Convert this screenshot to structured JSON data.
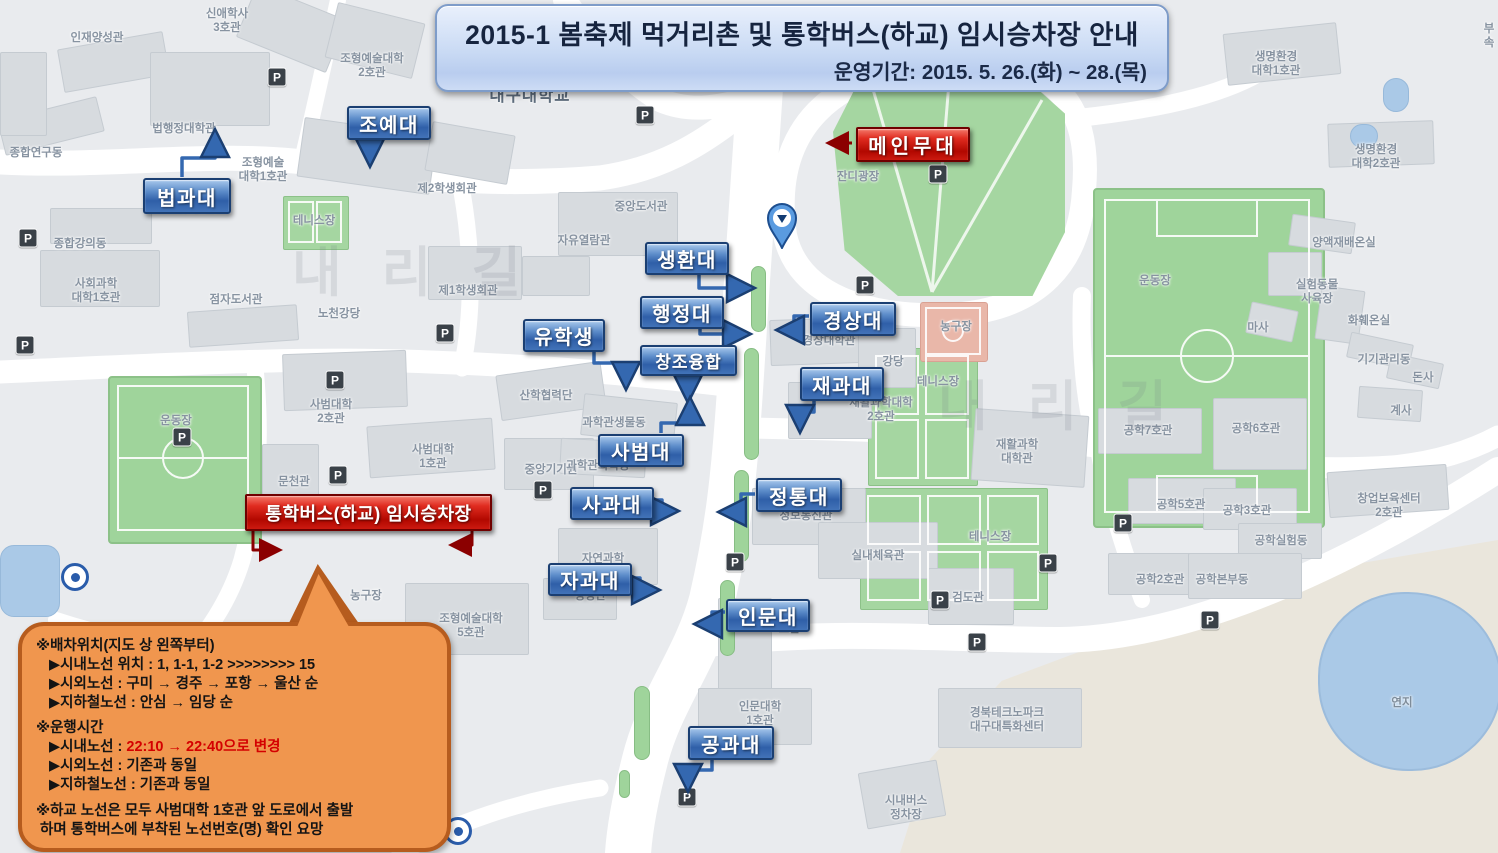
{
  "banner": {
    "title": "2015-1 봄축제 먹거리촌 및 통학버스(하교) 임시승차장 안내",
    "subtitle": "운영기간: 2015. 5. 26.(화) ~ 28.(목)"
  },
  "stage_label": {
    "text": "메인무대",
    "x": 856,
    "y": 127,
    "w": 110,
    "h": 31,
    "arrow": [
      [
        852,
        143
      ],
      [
        831,
        143
      ]
    ]
  },
  "bus_stop_label": {
    "text": "통학버스(하교) 임시승차장",
    "x": 245,
    "y": 494,
    "w": 243,
    "h": 33,
    "arrows": [
      [
        [
          253,
          528
        ],
        [
          253,
          550
        ],
        [
          277,
          550
        ]
      ],
      [
        [
          472,
          528
        ],
        [
          472,
          545
        ],
        [
          454,
          545
        ]
      ]
    ]
  },
  "college_labels": [
    {
      "text": "조예대",
      "x": 347,
      "y": 106,
      "w": 80,
      "h": 30,
      "arrow": [
        [
          370,
          139
        ],
        [
          370,
          160
        ]
      ]
    },
    {
      "text": "법과대",
      "x": 143,
      "y": 178,
      "w": 84,
      "h": 32,
      "arrow": [
        [
          182,
          177
        ],
        [
          182,
          158
        ],
        [
          215,
          158
        ],
        [
          215,
          136
        ]
      ]
    },
    {
      "text": "생환대",
      "x": 645,
      "y": 242,
      "w": 80,
      "h": 29,
      "arrow": [
        [
          699,
          272
        ],
        [
          699,
          288
        ],
        [
          748,
          288
        ]
      ]
    },
    {
      "text": "행정대",
      "x": 640,
      "y": 296,
      "w": 80,
      "h": 29,
      "arrow": [
        [
          700,
          326
        ],
        [
          700,
          334
        ],
        [
          744,
          334
        ]
      ]
    },
    {
      "text": "유학생",
      "x": 523,
      "y": 319,
      "w": 78,
      "h": 29,
      "arrow": [
        [
          594,
          349
        ],
        [
          594,
          363
        ],
        [
          626,
          363
        ],
        [
          626,
          383
        ]
      ]
    },
    {
      "text": "창조융합",
      "x": 640,
      "y": 345,
      "w": 93,
      "h": 27,
      "fs": "small",
      "arrow": [
        [
          688,
          373
        ],
        [
          688,
          396
        ]
      ]
    },
    {
      "text": "경상대",
      "x": 810,
      "y": 302,
      "w": 82,
      "h": 30,
      "arrow": [
        [
          809,
          316
        ],
        [
          794,
          316
        ],
        [
          794,
          330
        ],
        [
          783,
          330
        ]
      ]
    },
    {
      "text": "재과대",
      "x": 800,
      "y": 367,
      "w": 80,
      "h": 30,
      "arrow": [
        [
          814,
          398
        ],
        [
          814,
          412
        ],
        [
          800,
          412
        ],
        [
          800,
          426
        ]
      ]
    },
    {
      "text": "사범대",
      "x": 598,
      "y": 434,
      "w": 82,
      "h": 29,
      "arrow": [
        [
          661,
          433
        ],
        [
          661,
          423
        ],
        [
          690,
          423
        ],
        [
          690,
          404
        ]
      ]
    },
    {
      "text": "사과대",
      "x": 570,
      "y": 487,
      "w": 80,
      "h": 29,
      "arrow": [
        [
          651,
          500
        ],
        [
          662,
          500
        ],
        [
          662,
          511
        ],
        [
          672,
          511
        ]
      ]
    },
    {
      "text": "정통대",
      "x": 756,
      "y": 478,
      "w": 82,
      "h": 30,
      "arrow": [
        [
          755,
          494
        ],
        [
          741,
          494
        ],
        [
          741,
          512
        ],
        [
          725,
          512
        ]
      ]
    },
    {
      "text": "자과대",
      "x": 548,
      "y": 563,
      "w": 80,
      "h": 29,
      "arrow": [
        [
          629,
          578
        ],
        [
          640,
          578
        ],
        [
          640,
          590
        ],
        [
          653,
          590
        ]
      ]
    },
    {
      "text": "인문대",
      "x": 726,
      "y": 599,
      "w": 80,
      "h": 29,
      "arrow": [
        [
          725,
          612
        ],
        [
          712,
          612
        ],
        [
          712,
          624
        ],
        [
          701,
          624
        ]
      ]
    },
    {
      "text": "공과대",
      "x": 688,
      "y": 726,
      "w": 82,
      "h": 30,
      "arrow": [
        [
          712,
          757
        ],
        [
          712,
          770
        ],
        [
          688,
          770
        ],
        [
          688,
          785
        ]
      ]
    }
  ],
  "notice": {
    "sections": [
      {
        "header": "※배차위치(지도 상 왼쪽부터)",
        "items": [
          "▶시내노선 위치 : 1, 1-1, 1-2 >>>>>>>> 15",
          "▶시외노선 : 구미 → 경주 → 포항 → 울산 순",
          "▶지하철노선 : 안심 → 임당 순"
        ]
      },
      {
        "header": "※운행시간",
        "items": [
          {
            "prefix": "▶시내노선 : ",
            "highlight": "22:10 → 22:40으로 변경"
          },
          "▶시외노선 : 기존과 동일",
          "▶지하철노선 : 기존과 동일"
        ]
      },
      {
        "header": "※하교 노선은 모두 사범대학 1호관 앞 도로에서 출발\n 하며 통학버스에 부착된 노선번호(명) 확인 요망",
        "items": []
      }
    ]
  },
  "colors": {
    "college_label_blue": "#2f5fa8",
    "alert_label_red": "#c00000",
    "notice_bg": "#f0964e",
    "banner_bg": "#c9daf4",
    "map_green": "#a5d6a1",
    "road_white": "#ffffff",
    "arrow_blue": "#3468b0",
    "arrow_red": "#8b0000",
    "pond_blue": "#aac9e7"
  },
  "map": {
    "parking_icon": "P",
    "parking_positions": [
      [
        277,
        77
      ],
      [
        645,
        115
      ],
      [
        938,
        174
      ],
      [
        28,
        238
      ],
      [
        25,
        345
      ],
      [
        445,
        333
      ],
      [
        335,
        380
      ],
      [
        182,
        437
      ],
      [
        543,
        490
      ],
      [
        735,
        562
      ],
      [
        940,
        600
      ],
      [
        977,
        642
      ],
      [
        1210,
        620
      ],
      [
        1048,
        563
      ],
      [
        1123,
        523
      ],
      [
        687,
        797
      ],
      [
        865,
        285
      ],
      [
        338,
        475
      ]
    ],
    "metro_positions": [
      [
        75,
        577
      ],
      [
        458,
        831
      ]
    ],
    "median_strips": [
      [
        751,
        266,
        13,
        64
      ],
      [
        744,
        348,
        13,
        110
      ],
      [
        734,
        470,
        13,
        90
      ],
      [
        720,
        580,
        13,
        74
      ],
      [
        634,
        686,
        14,
        72
      ],
      [
        619,
        770,
        9,
        26
      ]
    ],
    "watermarks": [
      {
        "text": "내리길",
        "x": 292,
        "y": 228
      },
      {
        "text": "내리길",
        "x": 938,
        "y": 362
      }
    ],
    "green_areas": [
      {
        "type": "lawn",
        "x": 833,
        "y": 68,
        "w": 232,
        "h": 228
      },
      {
        "type": "field",
        "x": 1093,
        "y": 188,
        "w": 228,
        "h": 336
      },
      {
        "type": "field",
        "x": 108,
        "y": 376,
        "w": 150,
        "h": 164
      },
      {
        "type": "tennis",
        "x": 283,
        "y": 196,
        "w": 64,
        "h": 52
      },
      {
        "type": "tennis",
        "x": 868,
        "y": 348,
        "w": 108,
        "h": 136
      },
      {
        "type": "tennis",
        "x": 860,
        "y": 488,
        "w": 186,
        "h": 120
      },
      {
        "type": "bball",
        "x": 920,
        "y": 302,
        "w": 66,
        "h": 58
      },
      {
        "type": "water",
        "x": 0,
        "y": 545,
        "w": 58,
        "h": 70
      },
      {
        "type": "water",
        "x": 1383,
        "y": 78,
        "w": 24,
        "h": 32
      },
      {
        "type": "water",
        "x": 1350,
        "y": 124,
        "w": 26,
        "h": 22
      }
    ],
    "pond": {
      "x": 1318,
      "y": 592,
      "w": 180,
      "h": 175
    },
    "offland": {
      "x": 900,
      "y": 540,
      "w": 598,
      "h": 313
    },
    "buildings": [
      [
        60,
        40,
        105,
        42,
        -10
      ],
      [
        243,
        0,
        95,
        55,
        22
      ],
      [
        330,
        12,
        88,
        55,
        14
      ],
      [
        150,
        52,
        118,
        72,
        0
      ],
      [
        0,
        108,
        100,
        34,
        -14
      ],
      [
        50,
        208,
        100,
        34,
        0
      ],
      [
        40,
        250,
        118,
        55,
        0
      ],
      [
        188,
        308,
        108,
        34,
        -4
      ],
      [
        300,
        126,
        132,
        58,
        8
      ],
      [
        428,
        128,
        82,
        48,
        10
      ],
      [
        428,
        246,
        92,
        52,
        0
      ],
      [
        558,
        192,
        118,
        62,
        0
      ],
      [
        522,
        256,
        66,
        38,
        0
      ],
      [
        283,
        352,
        122,
        55,
        -2
      ],
      [
        368,
        422,
        124,
        50,
        -4
      ],
      [
        262,
        444,
        55,
        58,
        0
      ],
      [
        498,
        368,
        104,
        44,
        -8
      ],
      [
        504,
        438,
        88,
        50,
        0
      ],
      [
        558,
        528,
        98,
        55,
        0
      ],
      [
        543,
        578,
        72,
        40,
        0
      ],
      [
        405,
        583,
        122,
        70,
        0
      ],
      [
        770,
        318,
        118,
        44,
        -2
      ],
      [
        858,
        328,
        56,
        58,
        0
      ],
      [
        788,
        382,
        82,
        55,
        0
      ],
      [
        973,
        412,
        112,
        70,
        4
      ],
      [
        752,
        488,
        112,
        55,
        0
      ],
      [
        818,
        522,
        118,
        55,
        0
      ],
      [
        928,
        568,
        84,
        55,
        0
      ],
      [
        718,
        598,
        52,
        118,
        0
      ],
      [
        698,
        688,
        112,
        55,
        0
      ],
      [
        938,
        688,
        142,
        58,
        0
      ],
      [
        1098,
        408,
        102,
        44,
        0
      ],
      [
        1213,
        398,
        92,
        70,
        0
      ],
      [
        1128,
        478,
        106,
        44,
        0
      ],
      [
        1203,
        488,
        92,
        40,
        0
      ],
      [
        1238,
        523,
        82,
        34,
        0
      ],
      [
        1108,
        553,
        92,
        40,
        0
      ],
      [
        1188,
        553,
        112,
        44,
        0
      ],
      [
        1328,
        468,
        118,
        44,
        -4
      ],
      [
        1225,
        28,
        112,
        50,
        -6
      ],
      [
        1328,
        122,
        104,
        42,
        -2
      ],
      [
        1290,
        218,
        62,
        30,
        8
      ],
      [
        1268,
        252,
        52,
        42,
        0
      ],
      [
        1248,
        306,
        46,
        30,
        12
      ],
      [
        1318,
        288,
        42,
        52,
        8
      ],
      [
        1348,
        338,
        62,
        24,
        12
      ],
      [
        1388,
        358,
        52,
        24,
        12
      ],
      [
        1358,
        388,
        62,
        30,
        4
      ],
      [
        0,
        52,
        45,
        82,
        0
      ],
      [
        862,
        766,
        78,
        55,
        -10
      ],
      [
        582,
        398,
        92,
        40,
        6
      ],
      [
        560,
        440,
        84,
        34,
        3
      ]
    ],
    "place_labels": [
      {
        "t": "인재양성관",
        "x": 97,
        "y": 31
      },
      {
        "t": "신애학사\n3호관",
        "x": 227,
        "y": 7
      },
      {
        "t": "조형예술대학\n2호관",
        "x": 372,
        "y": 52
      },
      {
        "t": "대구대학교",
        "x": 530,
        "y": 86,
        "cls": "univ"
      },
      {
        "t": "부속",
        "x": 1489,
        "y": 22
      },
      {
        "t": "생명환경\n대학1호관",
        "x": 1276,
        "y": 50
      },
      {
        "t": "생명환경\n대학2호관",
        "x": 1376,
        "y": 143
      },
      {
        "t": "종합연구동",
        "x": 36,
        "y": 146
      },
      {
        "t": "법행정대학관",
        "x": 184,
        "y": 122
      },
      {
        "t": "지원센터",
        "x": 196,
        "y": 202
      },
      {
        "t": "조형예술\n대학1호관",
        "x": 263,
        "y": 156
      },
      {
        "t": "테니스장",
        "x": 314,
        "y": 214
      },
      {
        "t": "제2학생회관",
        "x": 447,
        "y": 182
      },
      {
        "t": "종합강의동",
        "x": 80,
        "y": 237
      },
      {
        "t": "사회과학\n대학1호관",
        "x": 96,
        "y": 277
      },
      {
        "t": "점자도서관",
        "x": 236,
        "y": 293
      },
      {
        "t": "노천강당",
        "x": 339,
        "y": 307
      },
      {
        "t": "제1학생회관",
        "x": 468,
        "y": 284
      },
      {
        "t": "자유열람관",
        "x": 584,
        "y": 234
      },
      {
        "t": "중앙도서관",
        "x": 641,
        "y": 200
      },
      {
        "t": "잔디광장",
        "x": 858,
        "y": 170
      },
      {
        "t": "경상대학관",
        "x": 829,
        "y": 334
      },
      {
        "t": "강당",
        "x": 893,
        "y": 355
      },
      {
        "t": "농구장",
        "x": 956,
        "y": 320
      },
      {
        "t": "테니스장",
        "x": 938,
        "y": 375
      },
      {
        "t": "재활과학대학\n2호관",
        "x": 881,
        "y": 396
      },
      {
        "t": "재활과학\n대학관",
        "x": 1017,
        "y": 438
      },
      {
        "t": "테니스장",
        "x": 990,
        "y": 530
      },
      {
        "t": "정보통신관",
        "x": 806,
        "y": 509
      },
      {
        "t": "실내체육관",
        "x": 878,
        "y": 549
      },
      {
        "t": "검도관",
        "x": 968,
        "y": 591
      },
      {
        "t": "산학협력단",
        "x": 546,
        "y": 389
      },
      {
        "t": "중앙기기원",
        "x": 551,
        "y": 463
      },
      {
        "t": "과학관생물동",
        "x": 614,
        "y": 416
      },
      {
        "t": "과학관화학동",
        "x": 598,
        "y": 459
      },
      {
        "t": "사범대학\n2호관",
        "x": 331,
        "y": 398
      },
      {
        "t": "사범대학\n1호관",
        "x": 433,
        "y": 443
      },
      {
        "t": "문천관",
        "x": 294,
        "y": 475
      },
      {
        "t": "운동장",
        "x": 176,
        "y": 414
      },
      {
        "t": "농구장",
        "x": 366,
        "y": 589
      },
      {
        "t": "조형예술대학\n5호관",
        "x": 471,
        "y": 612
      },
      {
        "t": "자연과학\n대학관",
        "x": 603,
        "y": 552
      },
      {
        "t": "생명관",
        "x": 590,
        "y": 589
      },
      {
        "t": "인문대학\n1호관",
        "x": 760,
        "y": 700
      },
      {
        "t": "2호관",
        "x": 786,
        "y": 622
      },
      {
        "t": "경북테크노파크\n대구대특화센터",
        "x": 1007,
        "y": 706
      },
      {
        "t": "시내버스\n정차장",
        "x": 906,
        "y": 794
      },
      {
        "t": "공학7호관",
        "x": 1148,
        "y": 424
      },
      {
        "t": "공학6호관",
        "x": 1256,
        "y": 422
      },
      {
        "t": "공학5호관",
        "x": 1181,
        "y": 498
      },
      {
        "t": "공학3호관",
        "x": 1247,
        "y": 504
      },
      {
        "t": "공학실험동",
        "x": 1281,
        "y": 534
      },
      {
        "t": "공학2호관",
        "x": 1160,
        "y": 573
      },
      {
        "t": "공학본부동",
        "x": 1222,
        "y": 573
      },
      {
        "t": "창업보육센터\n2호관",
        "x": 1389,
        "y": 492
      },
      {
        "t": "운동장",
        "x": 1155,
        "y": 274
      },
      {
        "t": "양액재배온실",
        "x": 1344,
        "y": 236
      },
      {
        "t": "실험동물\n사육장",
        "x": 1317,
        "y": 278
      },
      {
        "t": "마사",
        "x": 1258,
        "y": 321
      },
      {
        "t": "화훼온실",
        "x": 1369,
        "y": 314
      },
      {
        "t": "기기관리동",
        "x": 1384,
        "y": 353
      },
      {
        "t": "돈사",
        "x": 1423,
        "y": 371
      },
      {
        "t": "계사",
        "x": 1401,
        "y": 404
      },
      {
        "t": "연지",
        "x": 1402,
        "y": 696,
        "cls": "water-label"
      }
    ]
  }
}
